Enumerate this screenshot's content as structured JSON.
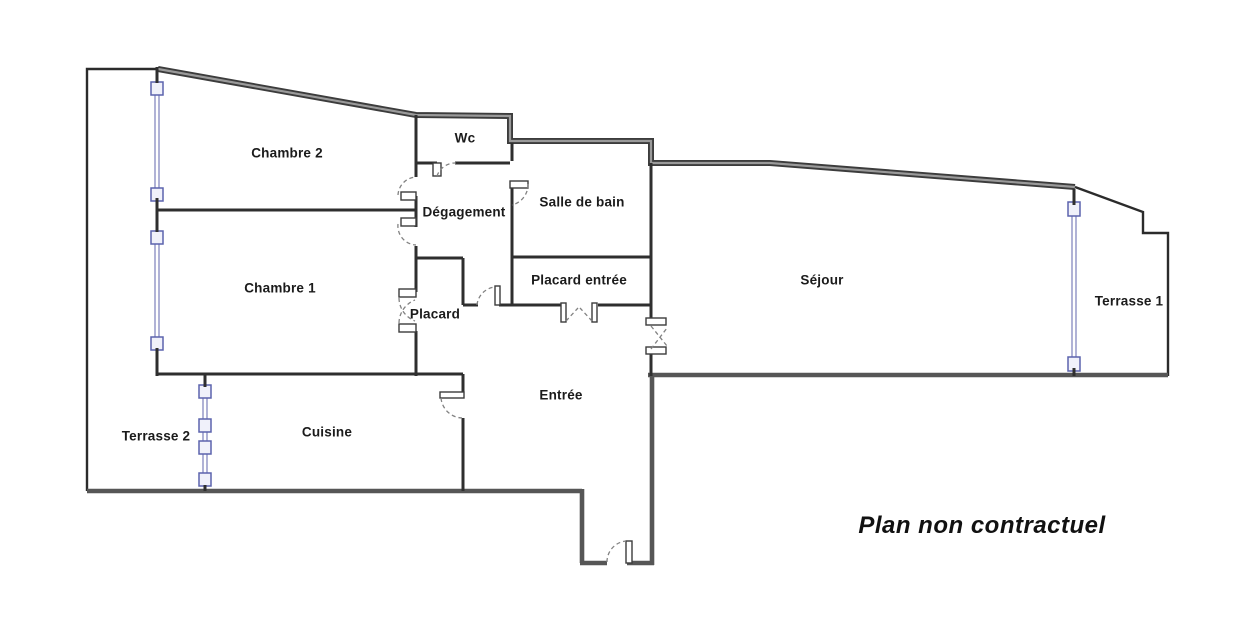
{
  "plan": {
    "disclaimer": "Plan non contractuel",
    "rooms": [
      {
        "id": "chambre-2",
        "label": "Chambre 2"
      },
      {
        "id": "wc",
        "label": "Wc"
      },
      {
        "id": "degagement",
        "label": "Dégagement"
      },
      {
        "id": "salle-de-bain",
        "label": "Salle de bain"
      },
      {
        "id": "chambre-1",
        "label": "Chambre 1"
      },
      {
        "id": "placard-entree",
        "label": "Placard entrée"
      },
      {
        "id": "sejour",
        "label": "Séjour"
      },
      {
        "id": "terrasse-1",
        "label": "Terrasse 1"
      },
      {
        "id": "placard",
        "label": "Placard"
      },
      {
        "id": "entree",
        "label": "Entrée"
      },
      {
        "id": "terrasse-2",
        "label": "Terrasse 2"
      },
      {
        "id": "cuisine",
        "label": "Cuisine"
      }
    ],
    "colors": {
      "wall": "#3c3c3c",
      "wall_light": "#565656",
      "window": "#7b80bb",
      "window_border": "#5c63ad",
      "window_fill": "#f0f1fa",
      "background": "#ffffff",
      "text": "#1b1b1b"
    }
  }
}
